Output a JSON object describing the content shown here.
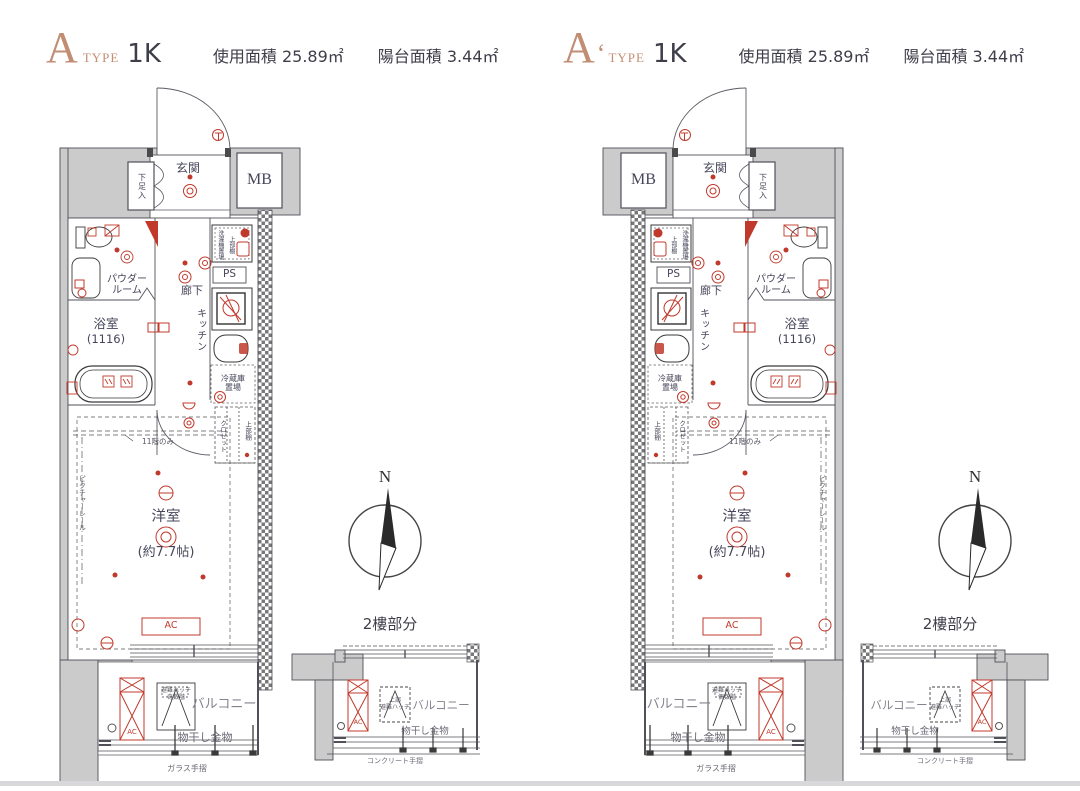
{
  "colors": {
    "accent": "#c28e73",
    "symbol_red": "#c0392b",
    "label_text": "#46465a",
    "wall_fill": "#cbcbcb",
    "gray_label": "#84848e",
    "divider": "#d8d8db"
  },
  "plans": [
    {
      "letter": "A",
      "prime": "",
      "type_label": "TYPE",
      "layout": "1K",
      "usage_area": "使用面積 25.89㎡",
      "balcony_area": "陽台面積 3.44㎡",
      "hatch_floor": "奇数階"
    },
    {
      "letter": "A",
      "prime": "‘",
      "type_label": "TYPE",
      "layout": "1K",
      "usage_area": "使用面積 25.89㎡",
      "balcony_area": "陽台面積 3.44㎡",
      "hatch_floor": "偶数階"
    }
  ],
  "labels": {
    "entrance": "玄関",
    "meter_box": "MB",
    "shoe_box": "下足入",
    "powder_room_line1": "パウダー",
    "powder_room_line2": "ルーム",
    "bathroom": "浴室",
    "bathroom_size": "(1116)",
    "corridor": "廊下",
    "kitchen": "キッチン",
    "pipe_space": "PS",
    "washer_place": "洗濯機置場",
    "upper_shelf": "上部棚",
    "fridge_line1": "冷蔵庫",
    "fridge_line2": "置場",
    "closet": "クロゼット",
    "western_room": "洋室",
    "western_room_size": "(約7.7帖)",
    "picture_rail": "ピクチャーレール",
    "eleventh_floor_only": "11階のみ",
    "air_conditioner": "AC",
    "balcony": "バルコニー",
    "evacuation_hatch": "避難ハッチ",
    "upper_part": "上部",
    "laundry_hardware": "物干し金物",
    "glass_railing": "ガラス手摺",
    "concrete_railing": "コンクリート手摺",
    "second_floor_section": "2樓部分",
    "north": "N"
  }
}
